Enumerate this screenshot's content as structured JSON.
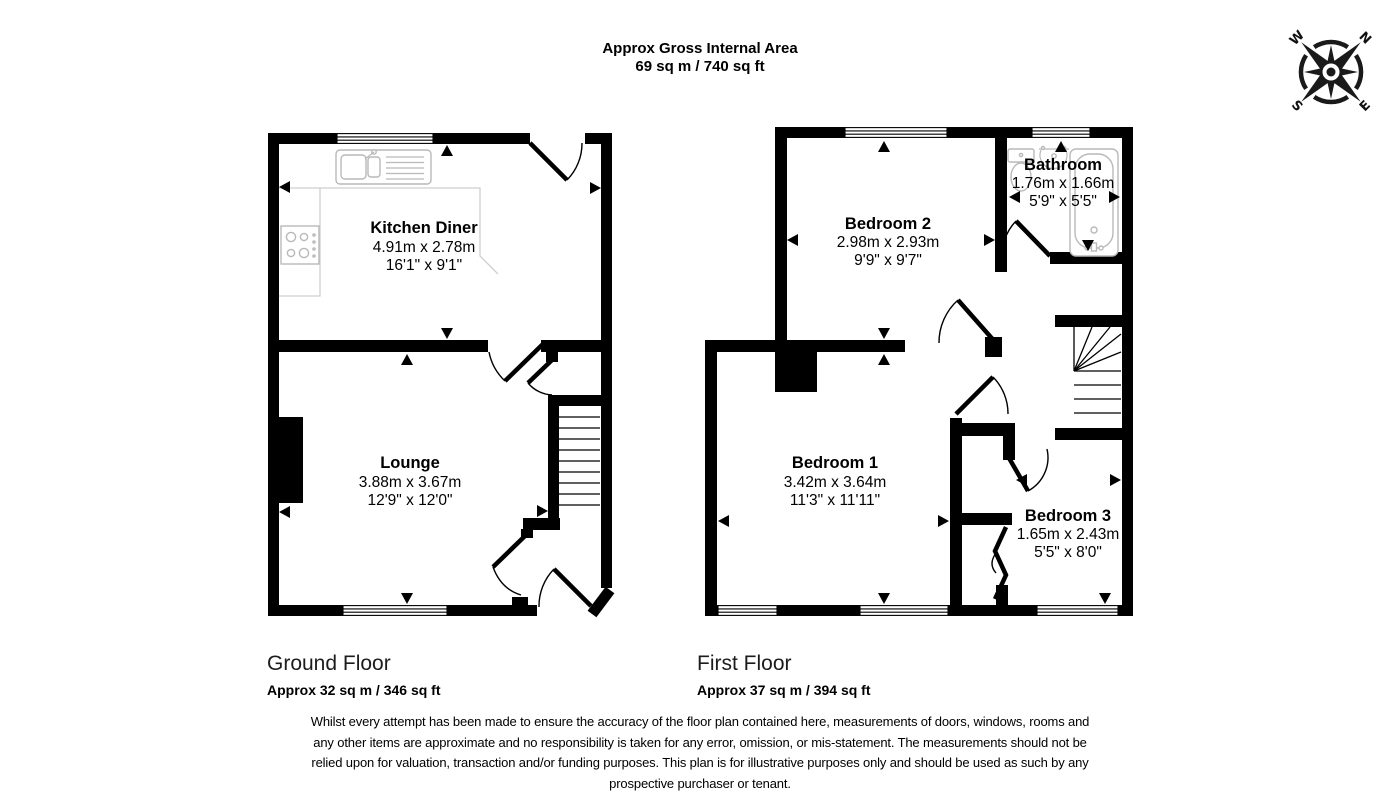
{
  "title": {
    "line1": "Approx Gross Internal Area",
    "line2": "69 sq m / 740 sq ft"
  },
  "compass": {
    "n": "N",
    "e": "E",
    "s": "S",
    "w": "W"
  },
  "floors": [
    {
      "name": "Ground Floor",
      "area": "Approx 32 sq m / 346 sq ft",
      "rooms": [
        {
          "name": "Kitchen Diner",
          "metric": "4.91m x 2.78m",
          "imperial": "16'1\" x 9'1\""
        },
        {
          "name": "Lounge",
          "metric": "3.88m x 3.67m",
          "imperial": "12'9\" x 12'0\""
        }
      ]
    },
    {
      "name": "First Floor",
      "area": "Approx 37 sq m / 394 sq ft",
      "rooms": [
        {
          "name": "Bedroom 2",
          "metric": "2.98m x 2.93m",
          "imperial": "9'9\" x 9'7\""
        },
        {
          "name": "Bathroom",
          "metric": "1.76m x 1.66m",
          "imperial": "5'9\" x 5'5\""
        },
        {
          "name": "Bedroom 1",
          "metric": "3.42m x 3.64m",
          "imperial": "11'3\" x 11'11\""
        },
        {
          "name": "Bedroom 3",
          "metric": "1.65m x 2.43m",
          "imperial": "5'5\" x 8'0\""
        }
      ]
    }
  ],
  "colors": {
    "wall": "#000000",
    "fixture": "#b9b9b9",
    "background": "#ffffff"
  },
  "disclaimer": {
    "line1": "Whilst every attempt has been made to ensure the accuracy of the floor plan contained here, measurements of doors, windows, rooms and",
    "line2": "any other items are approximate and no responsibility is taken for any error, omission, or mis-statement. The measurements should not be",
    "line3": "relied upon for valuation, transaction and/or funding purposes. This plan is for illustrative purposes only and should be used as such by any",
    "line4": "prospective purchaser or tenant."
  }
}
